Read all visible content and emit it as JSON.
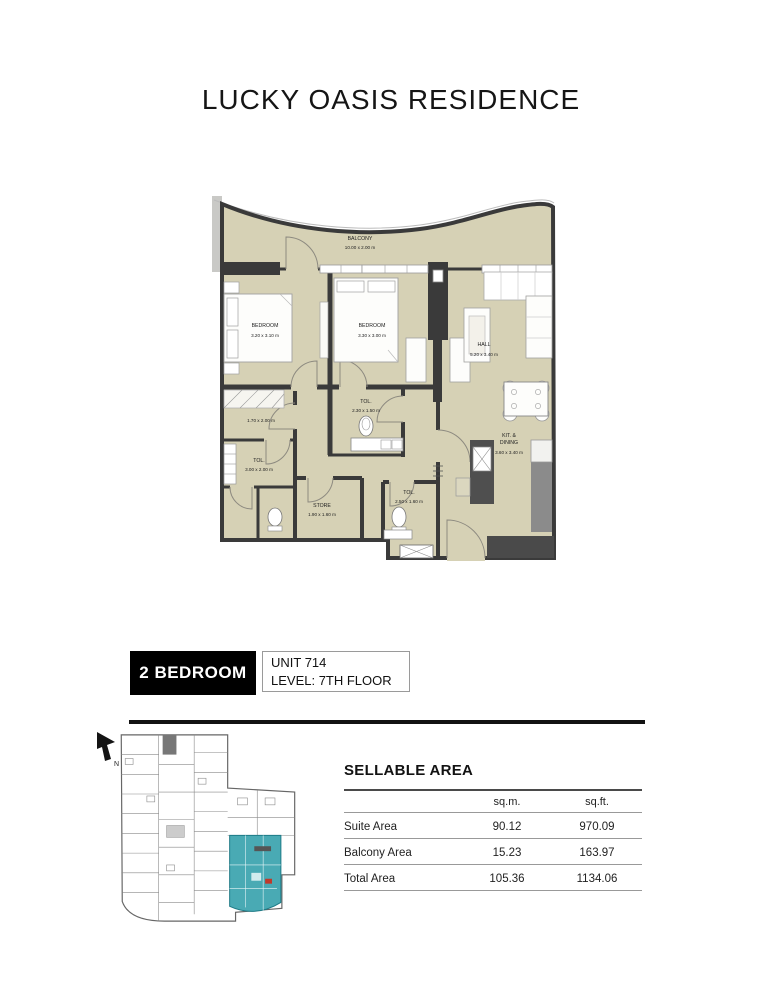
{
  "page": {
    "title": "LUCKY OASIS RESIDENCE"
  },
  "unit": {
    "type": "2 BEDROOM",
    "number": "UNIT 714",
    "level": "LEVEL: 7TH FLOOR"
  },
  "floorplan": {
    "rooms": [
      {
        "name": "BALCONY",
        "dims": "10.00 x 2.00 m"
      },
      {
        "name": "BEDROOM",
        "dims": "3.20 x 3.10 m"
      },
      {
        "name": "BEDROOM",
        "dims": "3.30 x 3.00 m"
      },
      {
        "name": "HALL",
        "dims": "5.20 x 3.40 m"
      },
      {
        "name": "TOL.",
        "dims": "2.30 x 1.50 m"
      },
      {
        "name": "",
        "dims": "1.70 x 2.00 m"
      },
      {
        "name": "TOL.",
        "dims": "3.00 x 2.00 m"
      },
      {
        "name": "STORE",
        "dims": "1.90 x 1.60 m"
      },
      {
        "name": "TOL.",
        "dims": "2.50 x 1.60 m"
      },
      {
        "name": "KIT. &",
        "name2": "DINING",
        "dims": "3.60 x 3.40 m"
      }
    ],
    "colors": {
      "floor": "#d6d1b5",
      "wall": "#3a3a3a"
    }
  },
  "keyplan": {
    "north_label": "N",
    "highlight_color": "#49aab4"
  },
  "sellable_area": {
    "title": "SELLABLE AREA",
    "columns": {
      "metric": "sq.m.",
      "imperial": "sq.ft."
    },
    "rows": [
      {
        "label": "Suite Area",
        "sqm": "90.12",
        "sqft": "970.09"
      },
      {
        "label": "Balcony Area",
        "sqm": "15.23",
        "sqft": "163.97"
      },
      {
        "label": "Total Area",
        "sqm": "105.36",
        "sqft": "1134.06"
      }
    ]
  }
}
